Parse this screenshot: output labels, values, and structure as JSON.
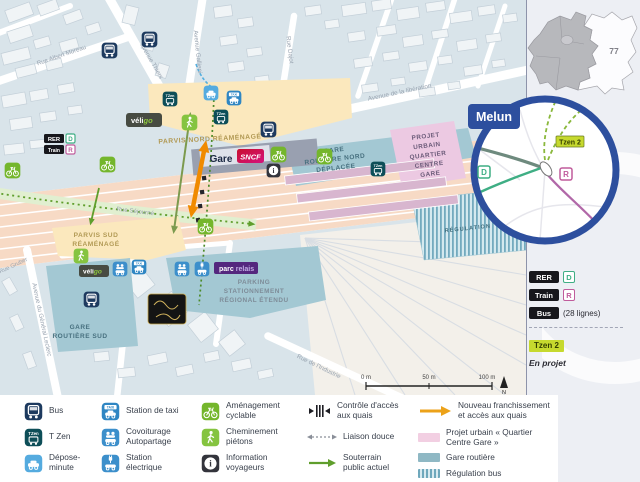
{
  "palette": {
    "accent_blue": "#2d4f9e",
    "railway_salmon": "#f7dac5",
    "parvis_yellow": "#fbe8bd",
    "bus_station_teal": "#a3c8d3",
    "project_pink": "#ecc9e2",
    "platform_pink": "#d8b6cf",
    "cycle_green": "#74b62c",
    "new_access_orange": "#f08a00",
    "tzen_green": "#c6d92e"
  },
  "map": {
    "streets": {
      "albert_moreau": "Rue Albert Moreau",
      "thiers": "Avenue Thiers",
      "gallieni": "Avenue Gallieni",
      "dajot": "Rue Dajot",
      "liberation": "Avenue de la libération",
      "sejourne": "Rue Séjourné",
      "leclerc": "Avenue du Général Leclerc",
      "gruber": "Rue Gruber",
      "industrie": "Rue de l'Industrie"
    },
    "areas": {
      "parvis_nord": "PARVIS NORD RÉAMÉNAGÉ",
      "parvis_sud": [
        "PARVIS SUD",
        "RÉAMÉNAGÉ"
      ],
      "gare_routiere_nord": [
        "GARE",
        "ROUTIÈRE NORD",
        "DÉPLACÉE"
      ],
      "projet_urbain": [
        "PROJET",
        "URBAIN",
        "QUARTIER",
        "CENTRE",
        "GARE"
      ],
      "regulation": "RÉGULATION",
      "gare_routiere_sud": [
        "GARE",
        "ROUTIÈRE SUD"
      ],
      "parking": [
        "PARKING",
        "STATIONNEMENT",
        "RÉGIONAL ÉTENDU"
      ]
    },
    "station": {
      "gare": "Gare",
      "sncf": "SNCF"
    },
    "badges": {
      "rer": "RER",
      "rer_line": "D",
      "train": "Train",
      "train_line": "R",
      "taxi": "TAXI",
      "tzen": "TZen",
      "info_glyph": "i",
      "veligo_1": "véli",
      "veligo_2": "go",
      "parc_relais_1": "parc",
      "parc_relais_2": "relais"
    },
    "scalebar": {
      "m0": "0 m",
      "m50": "50 m",
      "m100": "100 m",
      "north": "N"
    }
  },
  "inset": {
    "city": "Melun",
    "line_d": "D",
    "line_r": "R",
    "tzen2": "Tzen 2"
  },
  "region_map": {
    "dept": "77"
  },
  "sidebar_legend": {
    "rer": "RER",
    "rer_line": "D",
    "train": "Train",
    "train_line": "R",
    "bus": "Bus",
    "bus_note": "(28 lignes)",
    "tzen2": "Tzen 2",
    "tzen2_note": "En projet"
  },
  "legend": {
    "bus": "Bus",
    "tzen": "T Zen",
    "depose": "Dépose-minute",
    "taxi": "Station de taxi",
    "covoiturage": "Covoiturage Autopartage",
    "electrique": "Station électrique",
    "cyclable": "Aménagement cyclable",
    "pietons": "Cheminement piétons",
    "info": "Information voyageurs",
    "controle": "Contrôle d'accès aux quais",
    "liaison": "Liaison douce",
    "souterrain": "Souterrain public actuel",
    "franchissement": "Nouveau franchissement et accès aux quais",
    "projet": "Projet urbain « Quartier Centre Gare »",
    "gare_routiere": "Gare routière",
    "regulation": "Régulation bus",
    "parvis": "Parvis réaménagé"
  }
}
